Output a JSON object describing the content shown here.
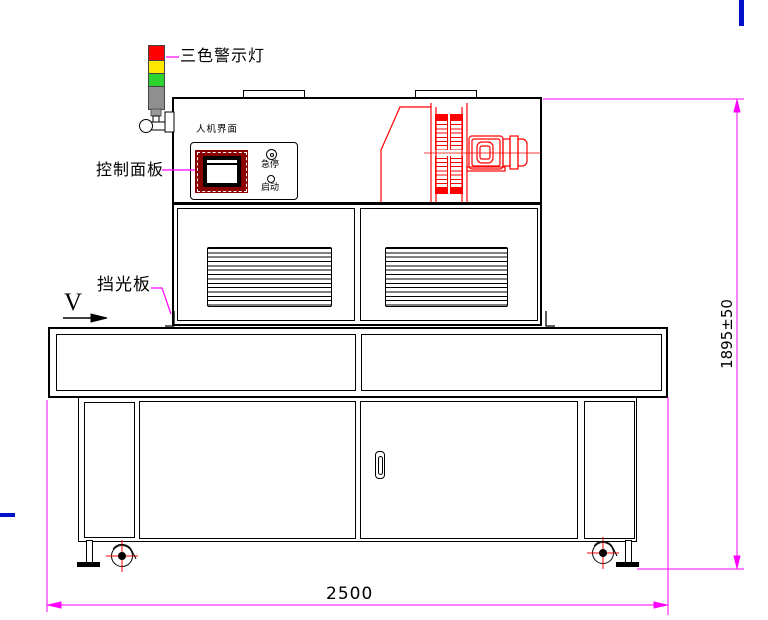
{
  "drawing": {
    "callouts": {
      "warning_light": "三色警示灯",
      "control_panel": "控制面板",
      "light_shield": "挡光板"
    },
    "panel": {
      "hmi": "人机界面",
      "estop": "急停",
      "start": "启动"
    },
    "conveyor": {
      "direction_symbol": "V"
    },
    "dimensions": {
      "overall_width_mm": "2500",
      "overall_height_mm": "1895±50"
    },
    "colors": {
      "outline": "#000000",
      "dimension_magenta": "#ff00ff",
      "equipment_red": "#ff0000",
      "screen_frame_maroon": "#8b0000",
      "light_red": "#ff0000",
      "light_yellow": "#ffe800",
      "light_green": "#2fd32f",
      "light_pole_gray": "#8f8f8f",
      "stray_blue": "#0011cc"
    }
  }
}
